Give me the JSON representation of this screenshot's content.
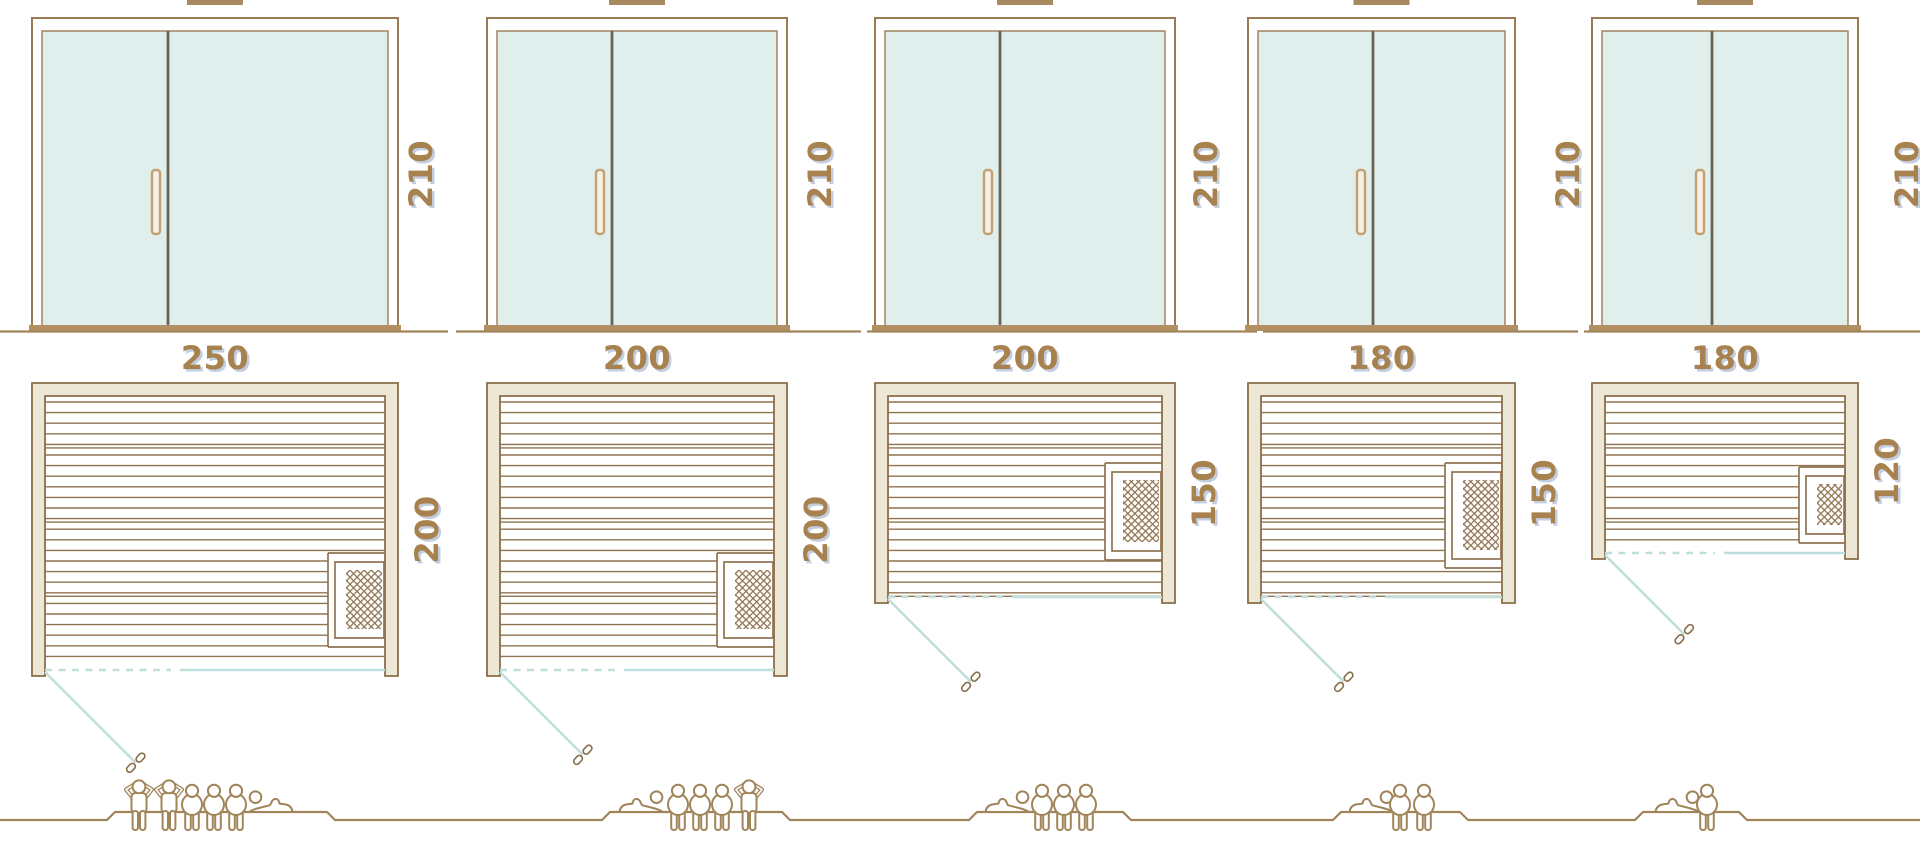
{
  "diagram": {
    "type": "sauna-size-comparison",
    "views": [
      "door-front-elevation",
      "floor-plan",
      "capacity-figures"
    ],
    "colors": {
      "frame_brown": "#9b7b55",
      "line_brown": "#8f7350",
      "wall_outline": "#8a6d4a",
      "wall_cream_fill": "#ece8d5",
      "glass_teal": "#e1efec",
      "swing_teal": "#bedfdb",
      "door_split_dark": "#6a6455",
      "threshold_brown": "#b29064",
      "vent_brown": "#a98a5e",
      "handle_tan": "#c3a171",
      "handle_fill": "#f5efe4",
      "figure_brown": "#a1855a",
      "label_brown": "#a8824e",
      "label_shadow": "#c3cde0",
      "background": "#ffffff"
    },
    "saunas": [
      {
        "name": "sauna-250x200",
        "width_cm": 250,
        "depth_cm": 200,
        "height_cm": 210,
        "height_label": "210",
        "width_label": "250",
        "depth_label": "200",
        "capacity": {
          "standing": 2,
          "sitting": 3,
          "lying": 1,
          "arrangement": [
            "standing",
            "standing",
            "sitting",
            "sitting",
            "sitting",
            "lying-right"
          ]
        }
      },
      {
        "name": "sauna-200x200",
        "width_cm": 200,
        "depth_cm": 200,
        "height_cm": 210,
        "height_label": "210",
        "width_label": "200",
        "depth_label": "200",
        "capacity": {
          "standing": 1,
          "sitting": 3,
          "lying": 1,
          "arrangement": [
            "lying-left",
            "sitting",
            "sitting",
            "sitting",
            "standing"
          ]
        }
      },
      {
        "name": "sauna-200x150",
        "width_cm": 200,
        "depth_cm": 150,
        "height_cm": 210,
        "height_label": "210",
        "width_label": "200",
        "depth_label": "150",
        "capacity": {
          "standing": 0,
          "sitting": 3,
          "lying": 1,
          "arrangement": [
            "lying-left",
            "sitting",
            "sitting",
            "sitting"
          ]
        }
      },
      {
        "name": "sauna-180x150",
        "width_cm": 180,
        "depth_cm": 150,
        "height_cm": 210,
        "height_label": "210",
        "width_label": "180",
        "depth_label": "150",
        "capacity": {
          "standing": 0,
          "sitting": 2,
          "lying": 1,
          "arrangement": [
            "lying-left",
            "sitting",
            "sitting"
          ]
        }
      },
      {
        "name": "sauna-180x120",
        "width_cm": 180,
        "depth_cm": 120,
        "height_cm": 210,
        "height_label": "210",
        "width_label": "180",
        "depth_label": "120",
        "capacity": {
          "standing": 0,
          "sitting": 1,
          "lying": 1,
          "arrangement": [
            "lying-left",
            "sitting"
          ]
        }
      }
    ],
    "icons": [
      "door-handle-icon",
      "heater-icon",
      "person-standing-icon",
      "person-sitting-icon",
      "person-lying-icon",
      "roof-vent-icon"
    ]
  }
}
